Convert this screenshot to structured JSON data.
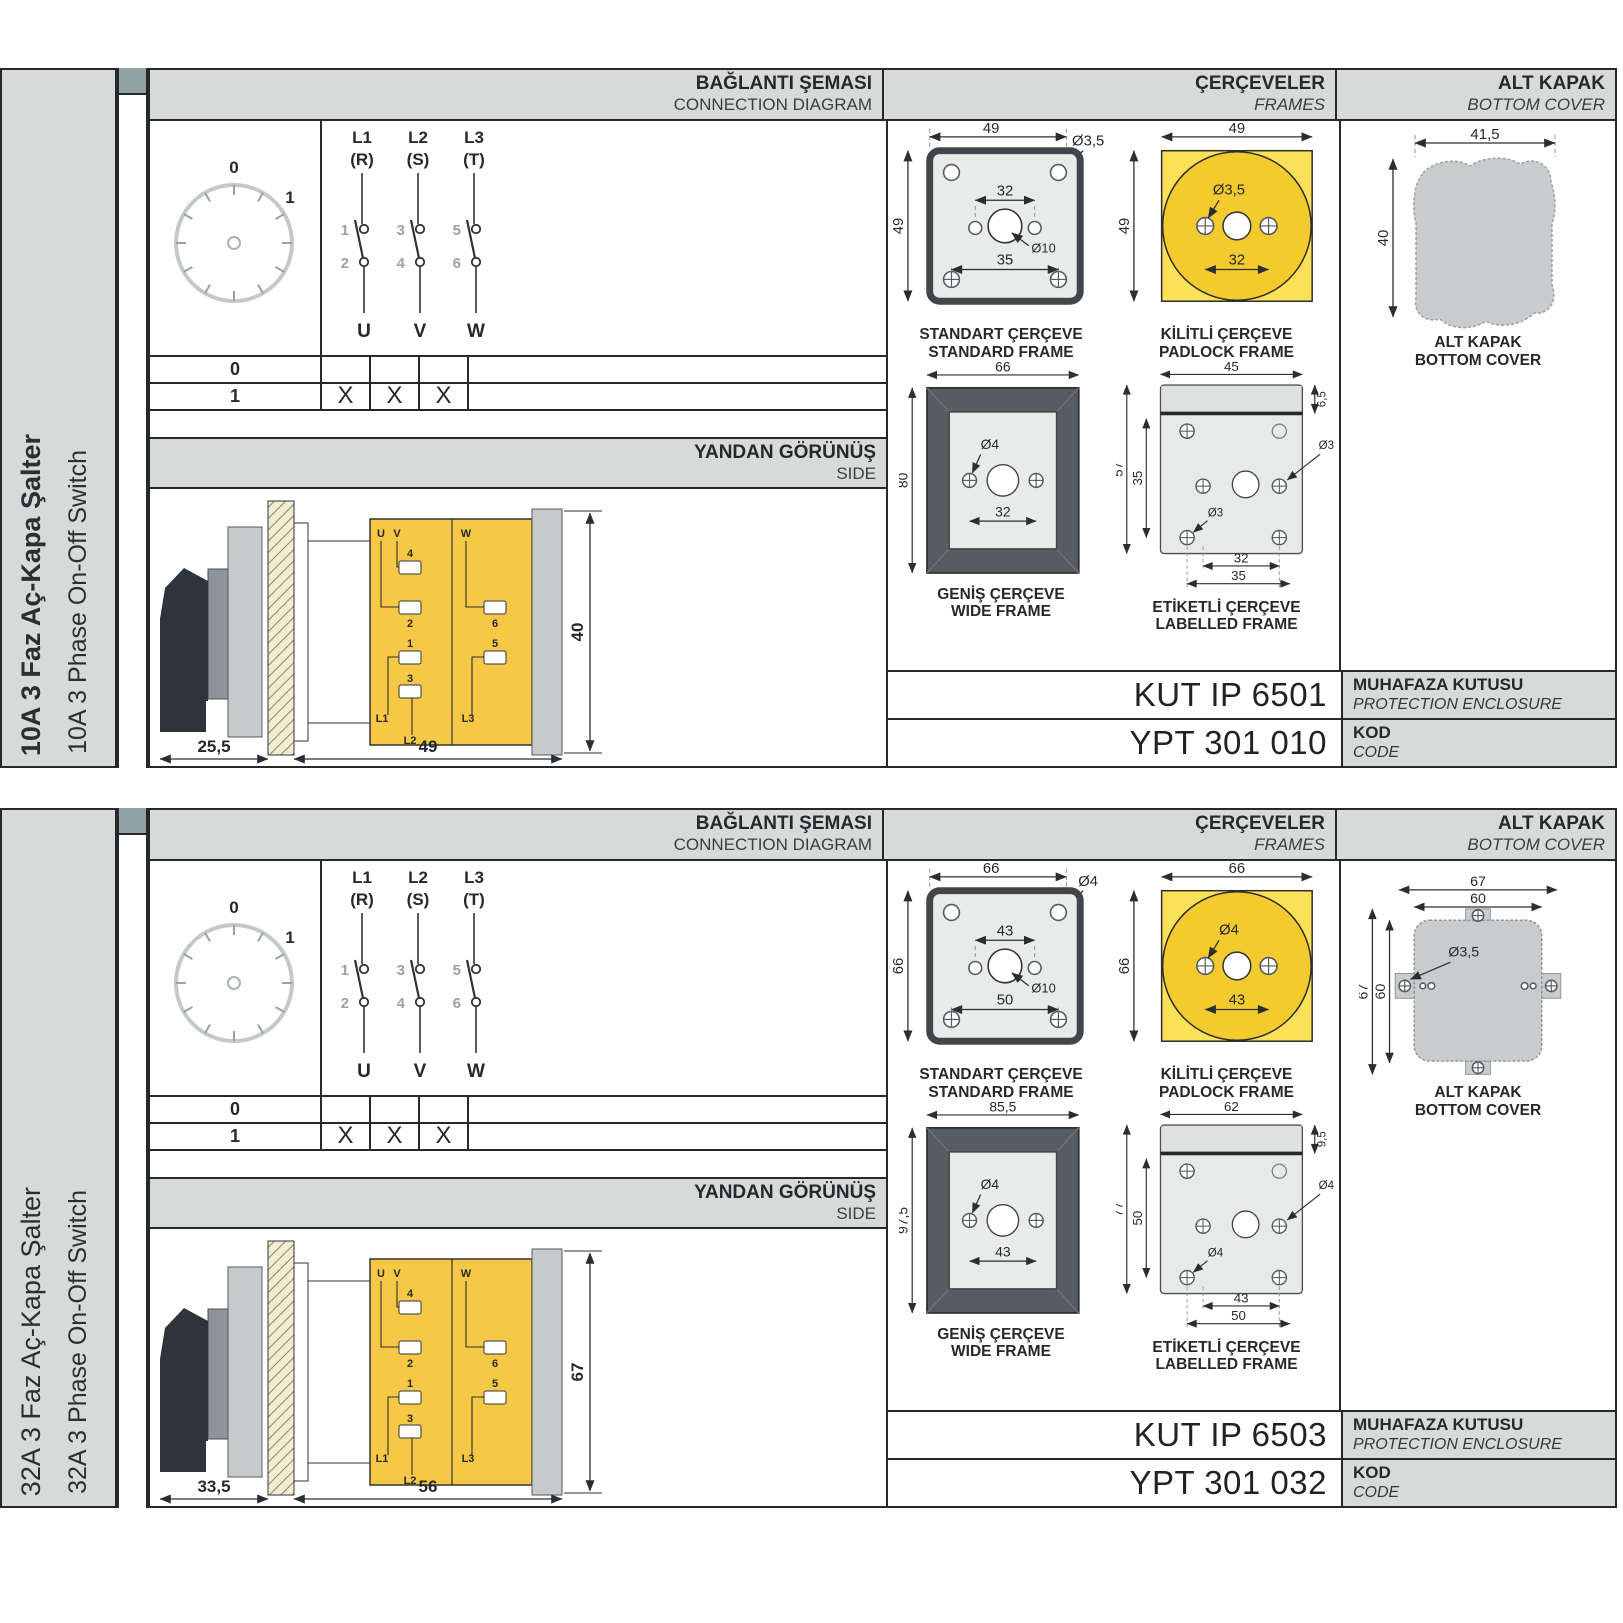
{
  "colors": {
    "panel_gray": "#d8dada",
    "tab_square": "#93a3a3",
    "line": "#26292c",
    "frame_fill": "#e9ebeb",
    "frame_dark": "#575c60",
    "yellow": "#f8d73e",
    "yellow_dark": "#f3cb2f",
    "yellow_light": "#fbe158",
    "body_yellow": "#f6c845",
    "plate_gray": "#c7caca",
    "cover_gray": "#c9cccc",
    "hatch_cream": "#f2ecd2",
    "handle_black": "#2e343b"
  },
  "sections": [
    {
      "sidebar": {
        "title": "10A 3 Faz Aç-Kapa Şalter",
        "subtitle": "10A 3 Phase On-Off Switch",
        "title_bold": true
      },
      "header": {
        "connection": {
          "title": "BAĞLANTI ŞEMASI",
          "subtitle": "CONNECTION DIAGRAM"
        },
        "frames": {
          "title": "ÇERÇEVELER",
          "subtitle": "FRAMES"
        },
        "cover": {
          "title": "ALT KAPAK",
          "subtitle": "BOTTOM COVER"
        }
      },
      "dial": {
        "pos_off": "0",
        "pos_on": "1"
      },
      "contacts": {
        "poles": [
          {
            "line": "L1",
            "phase": "(R)",
            "top": "1",
            "bottom": "2",
            "out": "U"
          },
          {
            "line": "L2",
            "phase": "(S)",
            "top": "3",
            "bottom": "4",
            "out": "V"
          },
          {
            "line": "L3",
            "phase": "(T)",
            "top": "5",
            "bottom": "6",
            "out": "W"
          }
        ]
      },
      "table": {
        "rows": [
          {
            "label": "0",
            "cells": [
              "",
              "",
              ""
            ]
          },
          {
            "label": "1",
            "cells": [
              "X",
              "X",
              "X"
            ]
          }
        ]
      },
      "side": {
        "title": "YANDAN GÖRÜNÜŞ",
        "subtitle": "SIDE",
        "dim_handle": "25,5",
        "dim_width": "49",
        "dim_height": "40",
        "terminals": {
          "u": "U",
          "v": "V",
          "w": "W",
          "t4": "4",
          "t2": "2",
          "t6": "6",
          "t1": "1",
          "t5": "5",
          "t3": "3",
          "l1": "L1",
          "l2": "L2",
          "l3": "L3"
        }
      },
      "frames": {
        "standard": {
          "caption_tr": "STANDART ÇERÇEVE",
          "caption_en": "STANDARD FRAME",
          "dim_w": "49",
          "dim_h": "49",
          "dim_hole": "Ø3,5",
          "dim_inner": "32",
          "dim_center": "Ø10",
          "dim_outer": "35"
        },
        "padlock": {
          "caption_tr": "KİLİTLİ ÇERÇEVE",
          "caption_en": "PADLOCK FRAME",
          "dim_w": "49",
          "dim_h": "49",
          "dim_hole": "Ø3,5",
          "dim_inner": "32"
        },
        "wide": {
          "caption_tr": "GENİŞ ÇERÇEVE",
          "caption_en": "WIDE FRAME",
          "dim_w": "66",
          "dim_h": "80",
          "dim_hole": "Ø4",
          "dim_inner": "32"
        },
        "labelled": {
          "caption_tr": "ETİKETLİ ÇERÇEVE",
          "caption_en": "LABELLED FRAME",
          "dim_w": "45",
          "dim_strip": "6,5",
          "dim_h": "57",
          "dim_inner_h": "35",
          "dim_hole_top": "Ø3",
          "dim_hole": "Ø3",
          "dim_inner": "32",
          "dim_outer": "35"
        }
      },
      "cover": {
        "variant": "blob",
        "caption_tr": "ALT KAPAK",
        "caption_en": "BOTTOM COVER",
        "dim_w": "41,5",
        "dim_h": "40"
      },
      "codes": {
        "enclosure": {
          "value": "KUT IP 6501",
          "label_tr": "MUHAFAZA KUTUSU",
          "label_en": "PROTECTION ENCLOSURE"
        },
        "code": {
          "value": "YPT 301 010",
          "label_tr": "KOD",
          "label_en": "CODE"
        }
      }
    },
    {
      "sidebar": {
        "title": "32A 3 Faz Aç-Kapa Şalter",
        "subtitle": "32A 3 Phase On-Off Switch",
        "title_bold": false
      },
      "header": {
        "connection": {
          "title": "BAĞLANTI ŞEMASI",
          "subtitle": "CONNECTION DIAGRAM"
        },
        "frames": {
          "title": "ÇERÇEVELER",
          "subtitle": "FRAMES"
        },
        "cover": {
          "title": "ALT KAPAK",
          "subtitle": "BOTTOM COVER"
        }
      },
      "dial": {
        "pos_off": "0",
        "pos_on": "1"
      },
      "contacts": {
        "poles": [
          {
            "line": "L1",
            "phase": "(R)",
            "top": "1",
            "bottom": "2",
            "out": "U"
          },
          {
            "line": "L2",
            "phase": "(S)",
            "top": "3",
            "bottom": "4",
            "out": "V"
          },
          {
            "line": "L3",
            "phase": "(T)",
            "top": "5",
            "bottom": "6",
            "out": "W"
          }
        ]
      },
      "table": {
        "rows": [
          {
            "label": "0",
            "cells": [
              "",
              "",
              ""
            ]
          },
          {
            "label": "1",
            "cells": [
              "X",
              "X",
              "X"
            ]
          }
        ]
      },
      "side": {
        "title": "YANDAN GÖRÜNÜŞ",
        "subtitle": "SIDE",
        "dim_handle": "33,5",
        "dim_width": "56",
        "dim_height": "67",
        "terminals": {
          "u": "U",
          "v": "V",
          "w": "W",
          "t4": "4",
          "t2": "2",
          "t6": "6",
          "t1": "1",
          "t5": "5",
          "t3": "3",
          "l1": "L1",
          "l2": "L2",
          "l3": "L3"
        }
      },
      "frames": {
        "standard": {
          "caption_tr": "STANDART ÇERÇEVE",
          "caption_en": "STANDARD FRAME",
          "dim_w": "66",
          "dim_h": "66",
          "dim_hole": "Ø4",
          "dim_inner": "43",
          "dim_center": "Ø10",
          "dim_outer": "50"
        },
        "padlock": {
          "caption_tr": "KİLİTLİ ÇERÇEVE",
          "caption_en": "PADLOCK FRAME",
          "dim_w": "66",
          "dim_h": "66",
          "dim_hole": "Ø4",
          "dim_inner": "43"
        },
        "wide": {
          "caption_tr": "GENİŞ ÇERÇEVE",
          "caption_en": "WIDE FRAME",
          "dim_w": "85,5",
          "dim_h": "97,5",
          "dim_hole": "Ø4",
          "dim_inner": "43"
        },
        "labelled": {
          "caption_tr": "ETİKETLİ ÇERÇEVE",
          "caption_en": "LABELLED FRAME",
          "dim_w": "62",
          "dim_strip": "9,5",
          "dim_h": "77",
          "dim_inner_h": "50",
          "dim_hole_top": "Ø4",
          "dim_hole": "Ø4",
          "dim_inner": "43",
          "dim_outer": "50"
        }
      },
      "cover": {
        "variant": "tabbed",
        "caption_tr": "ALT KAPAK",
        "caption_en": "BOTTOM COVER",
        "dim_w_outer": "67",
        "dim_w_inner": "60",
        "dim_h_outer": "67",
        "dim_h_inner": "60",
        "dim_hole": "Ø3,5"
      },
      "codes": {
        "enclosure": {
          "value": "KUT IP 6503",
          "label_tr": "MUHAFAZA KUTUSU",
          "label_en": "PROTECTION ENCLOSURE"
        },
        "code": {
          "value": "YPT 301 032",
          "label_tr": "KOD",
          "label_en": "CODE"
        }
      }
    }
  ]
}
